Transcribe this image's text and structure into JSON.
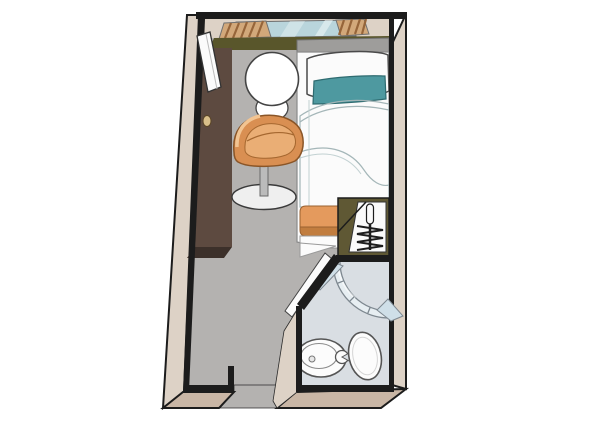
{
  "figure": {
    "kind": "floor-plan",
    "subject": "single cabin with en-suite bathroom"
  },
  "elements": [
    "entry-door",
    "window",
    "curtains",
    "window-sill",
    "wardrobe",
    "wardrobe-knob",
    "side-table",
    "swivel-chair",
    "single-bed",
    "pillow",
    "teal-accent-pillow",
    "duvet",
    "orange-foot-runner",
    "hanging-closet",
    "clothes-rod",
    "hangers",
    "bathroom",
    "shower-enclosure",
    "washbasin",
    "faucet",
    "toilet",
    "bathroom-door",
    "corridor-opening"
  ],
  "colors": {
    "wall_outline": "#1c1c1c",
    "wall_face": "#ddd2c6",
    "wall_face_bottom": "#c9b6a5",
    "floor": "#b4b2b0",
    "bathroom_floor": "#d9dee3",
    "wardrobe": "#5d4a40",
    "wardrobe_side": "#3c302a",
    "knob": "#d9bf8a",
    "window_glass": "#b9d5dc",
    "glass_streak": "#eef7f8",
    "curtain": "#d2a87a",
    "curtain_stripe": "#96653a",
    "sill": "#59562b",
    "headboard": "#9e9d9b",
    "door": "#fbfbfb",
    "bed_white": "#fbfbfb",
    "duvet": "#ebf2f2",
    "pillow_accent": "#4e99a0",
    "runner": "#e49a5d",
    "runner_dark": "#c17d3f",
    "chair": "#d98f52",
    "chair_seat": "#eaae75",
    "chair_highlight": "#f2c492",
    "chair_base": "#efefef",
    "chair_post": "#bbbbbb",
    "closet_face": "#5f5834",
    "closet_interior": "#fafafa",
    "shower_glass": "#e7eef2",
    "shower_fin": "#cfdfe8",
    "fixture": "#fcfcfc"
  }
}
